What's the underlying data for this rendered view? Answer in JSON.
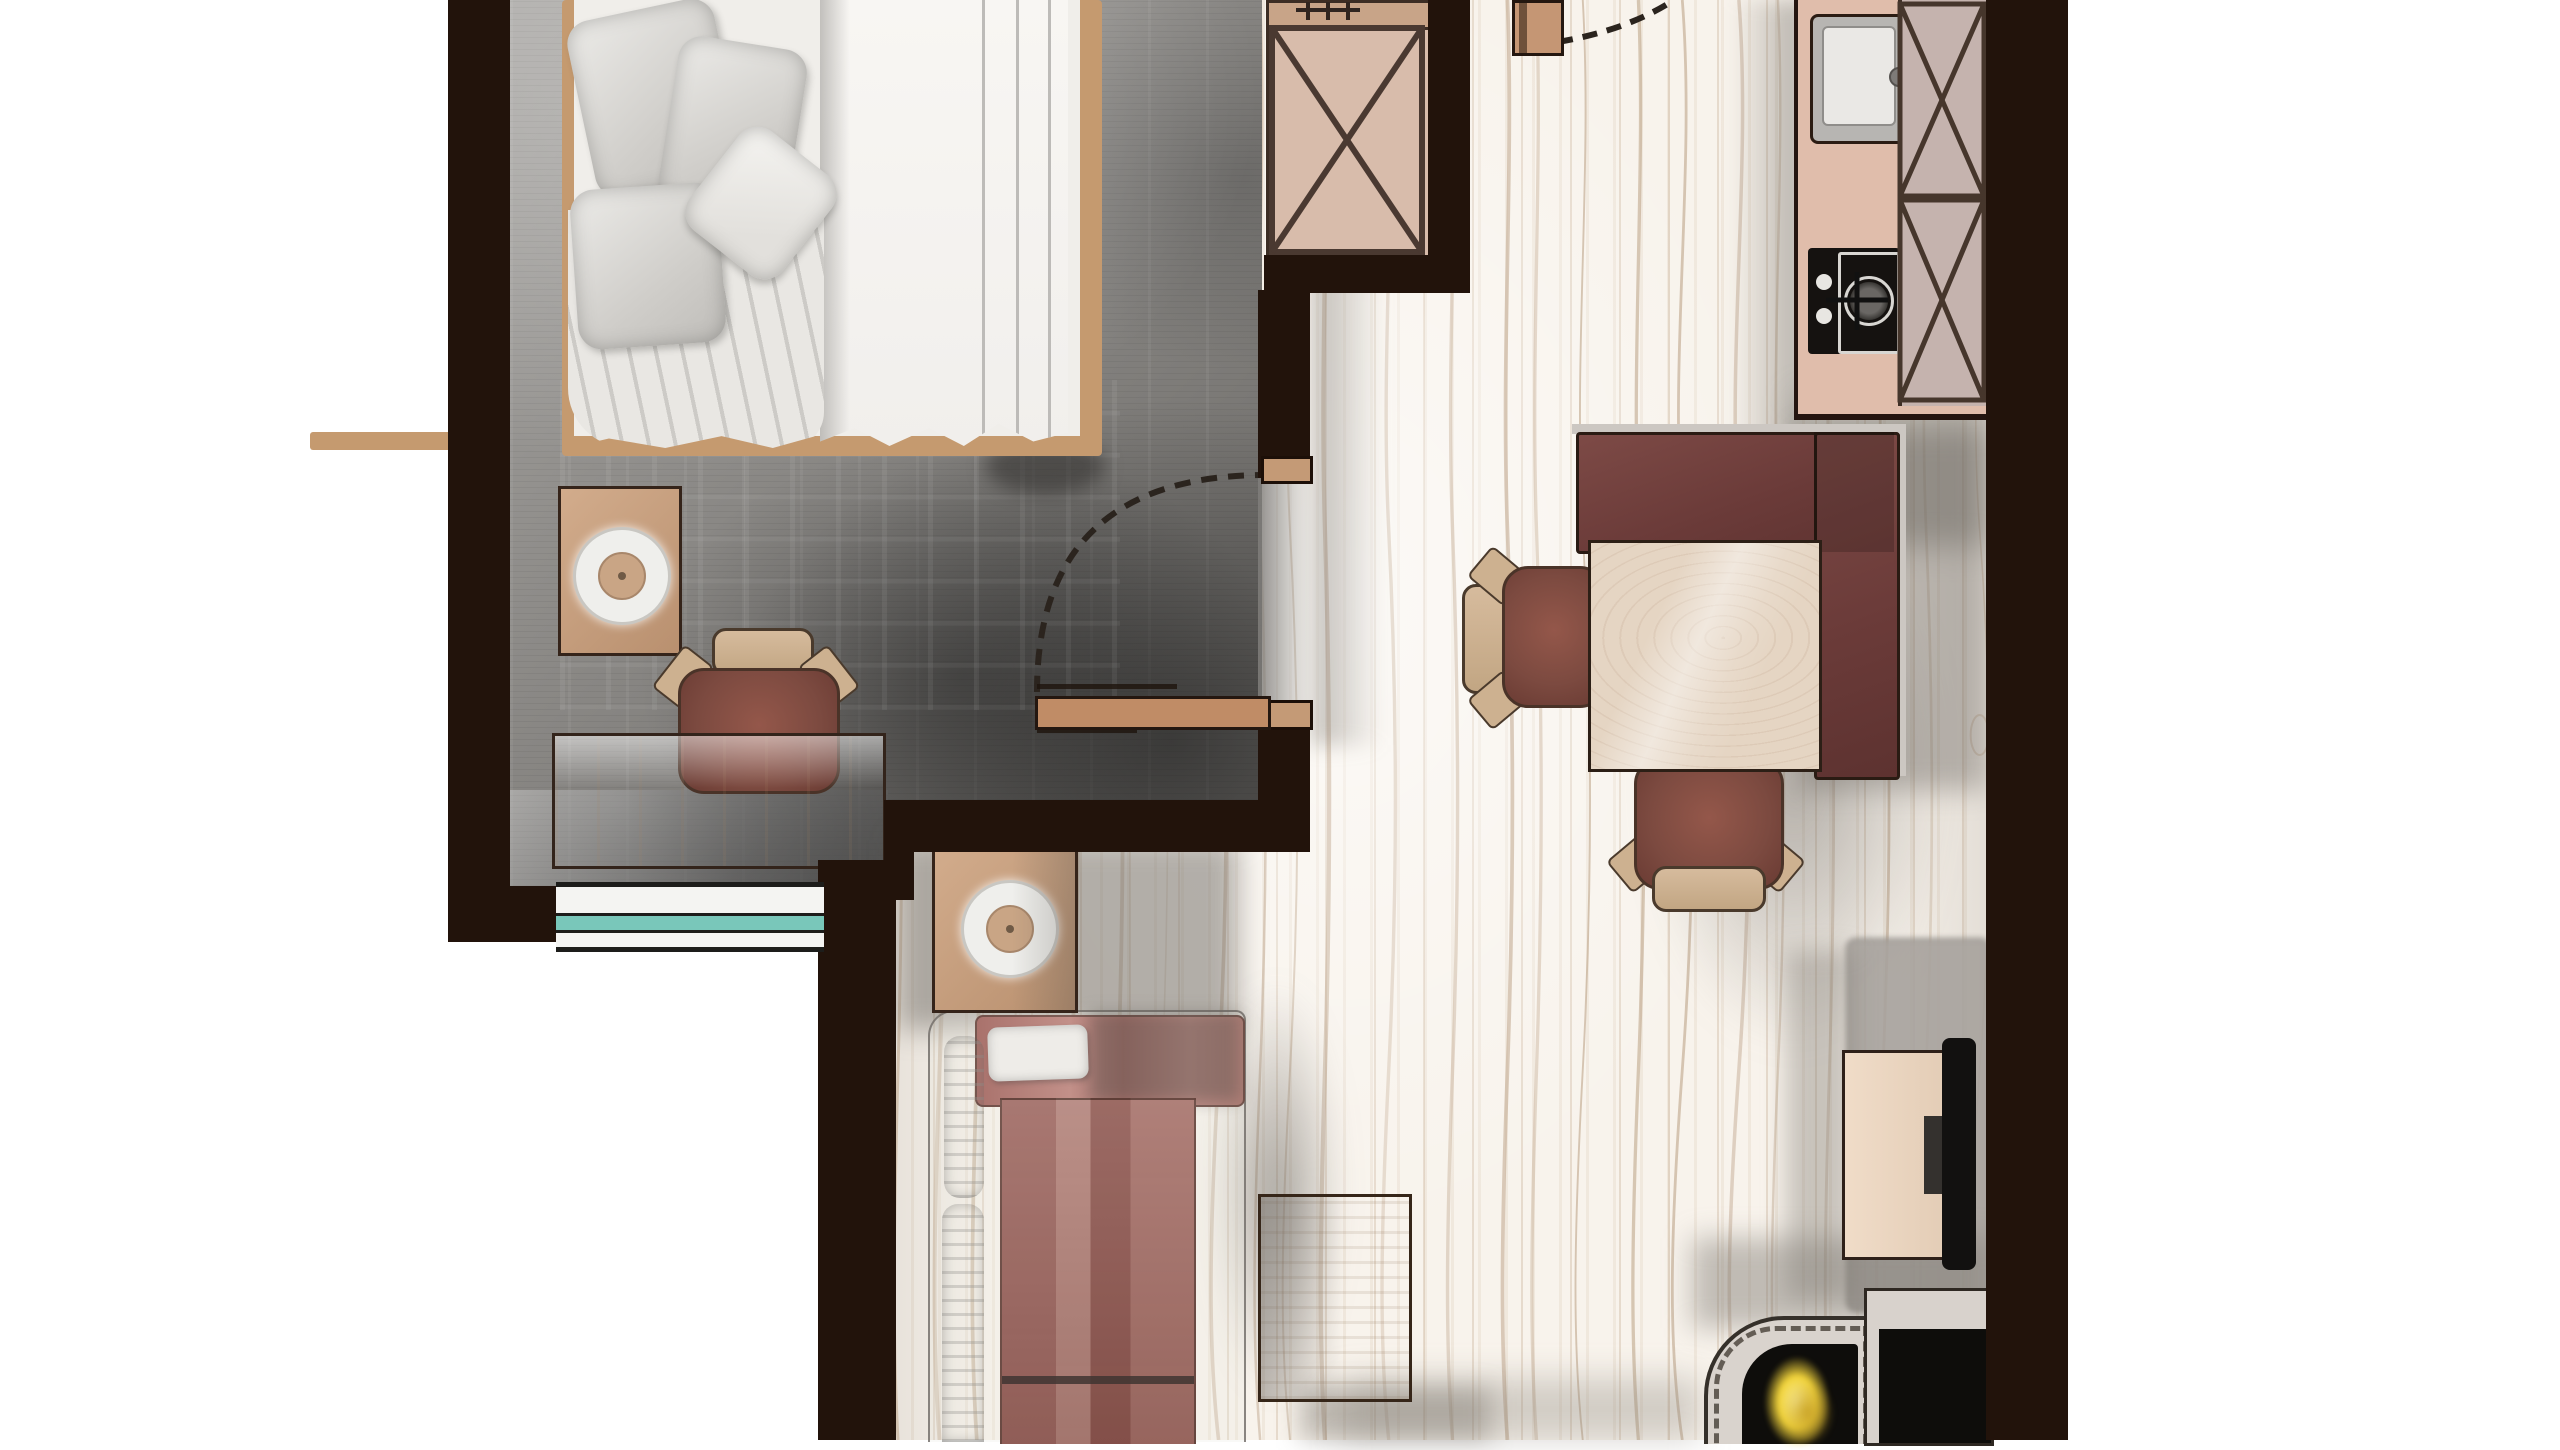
{
  "app": {
    "type": "apartment floor plan rendering",
    "view": "top-down",
    "style": "hand-drawn watercolor presentation plan",
    "text_labels": []
  },
  "palette": {
    "background": "#ffffff",
    "wall": "#22130b",
    "wall_cap": "#c49a76",
    "wood_floor": "#f8f3ec",
    "plank_line": "#c0a284",
    "carpet_gray": "#8f8d8a",
    "bed_linen": "#f2f0ed",
    "pillow_gray": "#d7d5d2",
    "bed_frame_wood": "#c59a6f",
    "furniture_wood_light": "#e6d4c1",
    "furniture_wood_mid": "#cdab89",
    "furniture_wood_tan": "#c9a384",
    "upholstery_maroon": "#9a635b",
    "bench_maroon": "#6b3b39",
    "chair_frame_tan": "#ccb092",
    "window_glass_teal": "#79c7ba",
    "door_wood": "#c08c66",
    "sink_steel": "#b7b5b2",
    "stove_black": "#151210",
    "burner_white": "#e8e6e2",
    "cabinet_gray": "#c5b3ae",
    "counter_pink": "#e0bdab",
    "bench_edge_gray": "#ccc7c2",
    "tv_black": "#121110",
    "tv_console_wood": "#ecd8c4",
    "firebox_black": "#0e0d0b",
    "flame_yellow": "#f0d23a",
    "flame_highlight": "#fdf0a0",
    "hearth_gray": "#d9d3cd",
    "swing_arc_dash": "#2b241e",
    "lamp_white": "#efefec",
    "lamp_shade_tan": "#c9a585"
  },
  "rooms": [
    {
      "id": "bedroom",
      "name": "bedroom"
    },
    {
      "id": "hallway",
      "name": "hallway"
    },
    {
      "id": "kitchenette",
      "name": "kitchenette"
    },
    {
      "id": "dining-nook",
      "name": "dining nook"
    },
    {
      "id": "living-area",
      "name": "living area"
    }
  ],
  "furniture": {
    "bedroom": [
      "double-bed",
      "pillows",
      "duvet",
      "nightstand",
      "table-lamp",
      "desk",
      "desk-chair",
      "wardrobe-with-x-symbol",
      "window-with-teal-glass",
      "open-door-with-swing-arc"
    ],
    "hallway": [
      "entry-door-jamb",
      "entry-door-swing-arc",
      "wood-plank-flooring"
    ],
    "kitchenette": [
      "sink-unit",
      "gas-cooktop",
      "tall-cabinets-with-x-symbols"
    ],
    "dining-nook": [
      "l-shaped-corner-bench",
      "square-dining-table",
      "dining-chair-left",
      "dining-chair-bottom"
    ],
    "living-area": [
      "sofa-with-cushions",
      "side-table",
      "table-lamp",
      "coffee-table",
      "tv-console",
      "wall-mounted-tv",
      "fireplace-with-flames",
      "hearth-panel",
      "gray-rug"
    ]
  }
}
